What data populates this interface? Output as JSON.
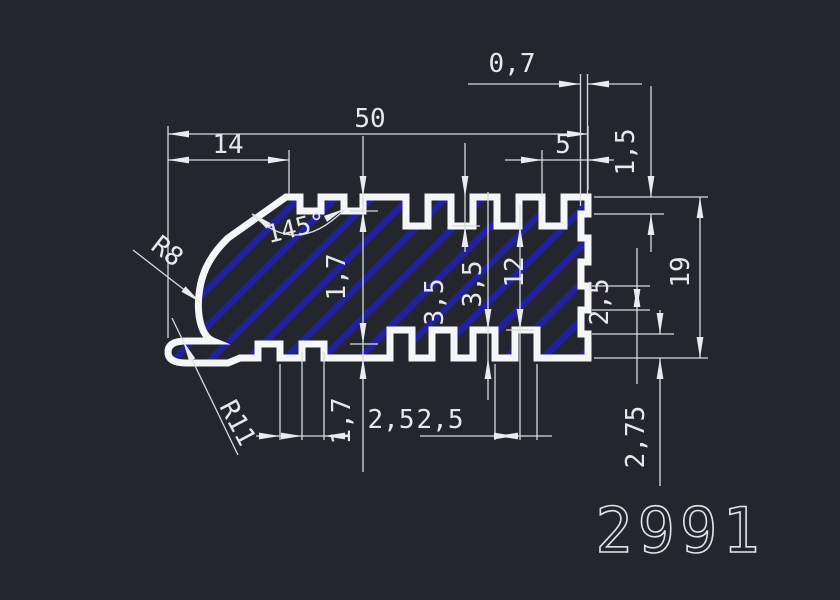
{
  "drawing": {
    "part_number": "2991",
    "dimensions": {
      "total_width": "50",
      "left_width": "14",
      "right_step_depth": "0,7",
      "right_top_width": "5",
      "right_top_offset": "1,5",
      "total_height": "19",
      "top_groove_depth": "1,7",
      "top_fin_depth": "3,5",
      "bottom_fin_depth": "3,5",
      "core_height": "12",
      "right_tooth_pitch": "2,5",
      "bottom_right_margin": "2,75",
      "bottom_groove_depth": "1,7",
      "bottom_groove_w1": "2,5",
      "bottom_groove_w2": "2,5",
      "chamfer_angle": "145°",
      "radius_outer": "R8",
      "radius_inner": "R11"
    },
    "colors": {
      "background": "#23272d",
      "outline": "#f4f6f7",
      "hatch": "#2121a0",
      "dimension_lines": "#d6dadd",
      "text": "#e6e9eb"
    }
  }
}
